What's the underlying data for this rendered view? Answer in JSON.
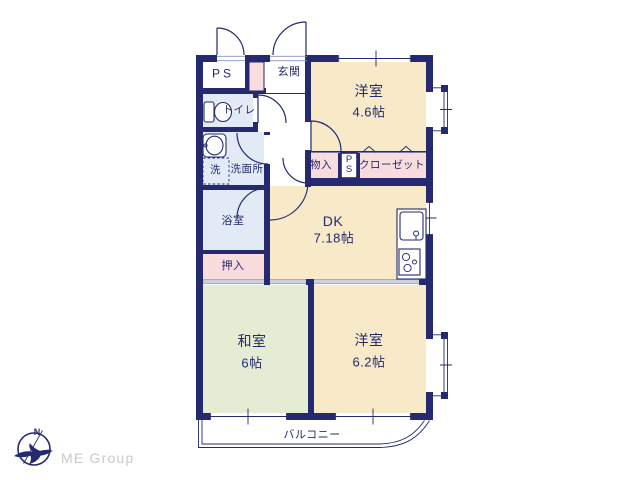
{
  "branding": {
    "logo_text": "ME Group",
    "compass_north_label": "N"
  },
  "colors": {
    "wall": "#242a6d",
    "text": "#242a6d",
    "cream": "#f8e9c9",
    "green": "#e4edd3",
    "blue": "#e2ebf5",
    "pink": "#f9dcdd",
    "track": "#ccd0dd",
    "track-border": "#9aa0ba",
    "logo-gray": "#c9c9c9",
    "paper": "#ffffff"
  },
  "floorplan": {
    "rooms": {
      "ps_top": {
        "label": "PS"
      },
      "entrance": {
        "label": "玄関"
      },
      "western_room_1": {
        "label": "洋室",
        "size": "4.6帖"
      },
      "toilet": {
        "label": "トイレ"
      },
      "washroom": {
        "label": "洗面所"
      },
      "laundry": {
        "label": "洗"
      },
      "bathroom": {
        "label": "浴室"
      },
      "storage": {
        "label": "物入"
      },
      "ps_mid": {
        "label": "PS"
      },
      "closet": {
        "label": "クローゼット"
      },
      "dining_kitchen": {
        "label": "DK",
        "size": "7.18帖"
      },
      "oshiire": {
        "label": "押入"
      },
      "japanese_room": {
        "label": "和室",
        "size": "6帖"
      },
      "western_room_2": {
        "label": "洋室",
        "size": "6.2帖"
      },
      "balcony": {
        "label": "バルコニー"
      }
    }
  }
}
